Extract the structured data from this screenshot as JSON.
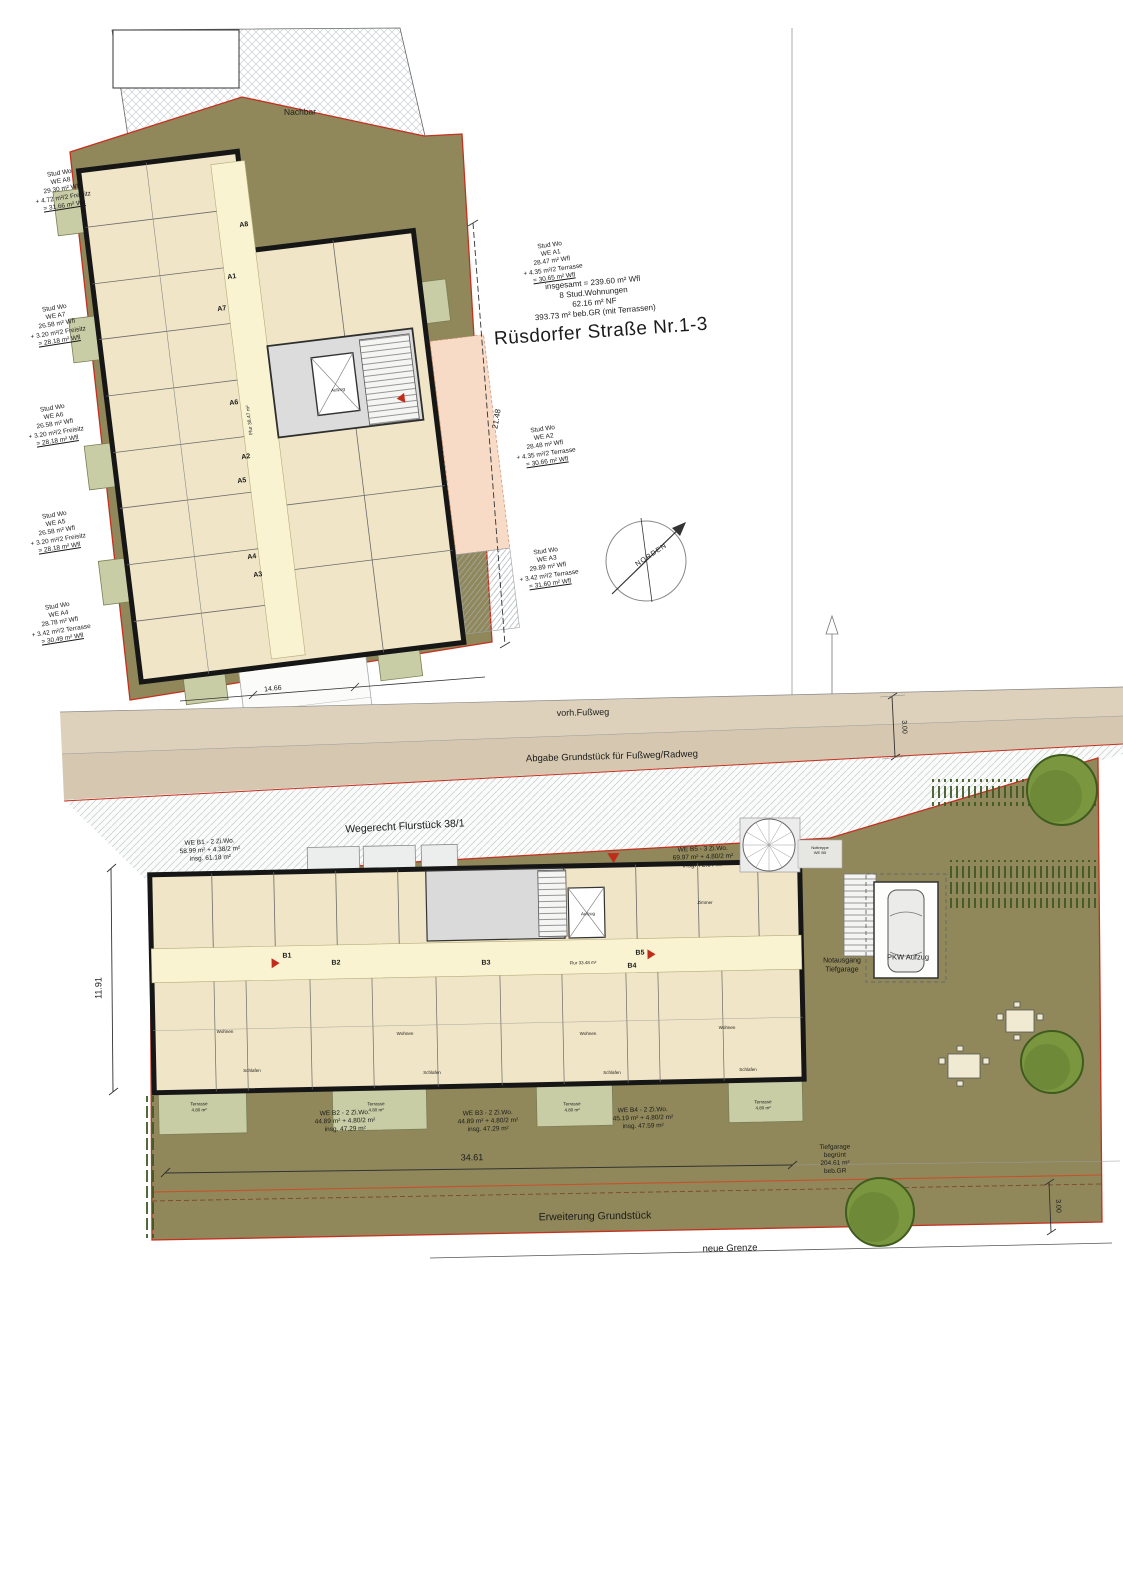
{
  "street_title": "Rüsdorfer Straße  Nr.1-3",
  "summary": "insgesamt = 239.60 m² Wfl\n8 Stud.Wohnungen\n62.16 m² NF\n393.73 m² beb.GR (mit Terrassen)",
  "neighbor_label": "Nachbar",
  "strips": {
    "fussweg": "vorh.Fußweg",
    "abgabe": "Abgabe Grundstück für Fußweg/Radweg",
    "wegerecht": "Wegerecht Flurstück 38/1"
  },
  "building_a": {
    "units": [
      {
        "l1": "Stud Wo",
        "l2": "WE A8",
        "l3": "29.30 m² Wfl",
        "l4": "+ 4.72 m²/2 Freisitz",
        "l5": "= 31.66 m² Wfl"
      },
      {
        "l1": "Stud Wo",
        "l2": "WE A7",
        "l3": "26.58 m² Wfl",
        "l4": "+ 3.20 m²/2 Freisitz",
        "l5": "= 28.18 m² Wfl"
      },
      {
        "l1": "Stud Wo",
        "l2": "WE A6",
        "l3": "26.58 m² Wfl",
        "l4": "+ 3.20 m²/2 Freisitz",
        "l5": "= 28.18 m² Wfl"
      },
      {
        "l1": "Stud Wo",
        "l2": "WE A5",
        "l3": "26.58 m² Wfl",
        "l4": "+ 3.20 m²/2 Freisitz",
        "l5": "= 28.18 m² Wfl"
      },
      {
        "l1": "Stud Wo",
        "l2": "WE A4",
        "l3": "28.78 m² Wfl",
        "l4": "+ 3.42 m²/2 Terrasse",
        "l5": "= 30.49 m² Wfl"
      },
      {
        "l1": "Stud Wo",
        "l2": "WE A1",
        "l3": "28.47 m² Wfl",
        "l4": "+ 4.35 m²/2 Terrasse",
        "l5": "= 30.65 m² Wfl"
      },
      {
        "l1": "Stud Wo",
        "l2": "WE A2",
        "l3": "28.48 m² Wfl",
        "l4": "+ 4.35 m²/2 Terrasse",
        "l5": "= 30.66 m² Wfl"
      },
      {
        "l1": "Stud Wo",
        "l2": "WE A3",
        "l3": "29.89 m² Wfl",
        "l4": "+ 3.42 m²/2 Terrasse",
        "l5": "= 31.60 m² Wfl"
      }
    ],
    "markers": [
      "A8",
      "A1",
      "A7",
      "A6",
      "A2",
      "A5",
      "A4",
      "A3"
    ],
    "flur": "Flur 38.47 m²",
    "aufzug": "Aufzug"
  },
  "building_b": {
    "units": [
      {
        "t": "WE B1 - 2 Zi.Wo.",
        "a": "58.99 m² + 4.38/2 m²",
        "i": "insg. 61.18 m²"
      },
      {
        "t": "WE B5 - 3 Zi.Wo.",
        "a": "69.97 m² + 4.80/2 m²",
        "i": "insg. 72.37 m²"
      },
      {
        "t": "WE B2 - 2 Zi.Wo.",
        "a": "44.89 m² + 4.80/2 m²",
        "i": "insg. 47.29 m²"
      },
      {
        "t": "WE B3 - 2 Zi.Wo.",
        "a": "44.89 m² + 4.80/2 m²",
        "i": "insg. 47.29 m²"
      },
      {
        "t": "WE B4 - 2 Zi.Wo.",
        "a": "45.19 m² + 4.80/2 m²",
        "i": "insg. 47.59 m²"
      }
    ],
    "markers": [
      "B1",
      "B2",
      "B3",
      "B4",
      "B5"
    ],
    "flur": "Flur 33.48 m²",
    "aufzug": "Aufzug",
    "terrasse": "Terrasse\n4.80 m²",
    "rooms": {
      "wohnen": "Wohnen",
      "schlafen": "Schlafen",
      "zimmer": "Zimmer"
    }
  },
  "site": {
    "erweiterung": "Erweiterung Grundstück",
    "neue_grenze": "neue Grenze",
    "tiefgarage": "Tiefgarage\nbegrünt\n204.61 m²\nbeb.GR",
    "notausgang": "Notausgang\nTiefgarage",
    "pkw_aufzug": "PKW Aufzug",
    "nottreppe": "Nottreppe\nWE B5"
  },
  "dimensions": {
    "d3461": "34.61",
    "d1191": "11.91",
    "d2148": "21.48",
    "d1466": "14.66",
    "d300_oben": "3.00",
    "d300_unten": "3.00"
  },
  "compass": {
    "label": "NORDEN"
  }
}
